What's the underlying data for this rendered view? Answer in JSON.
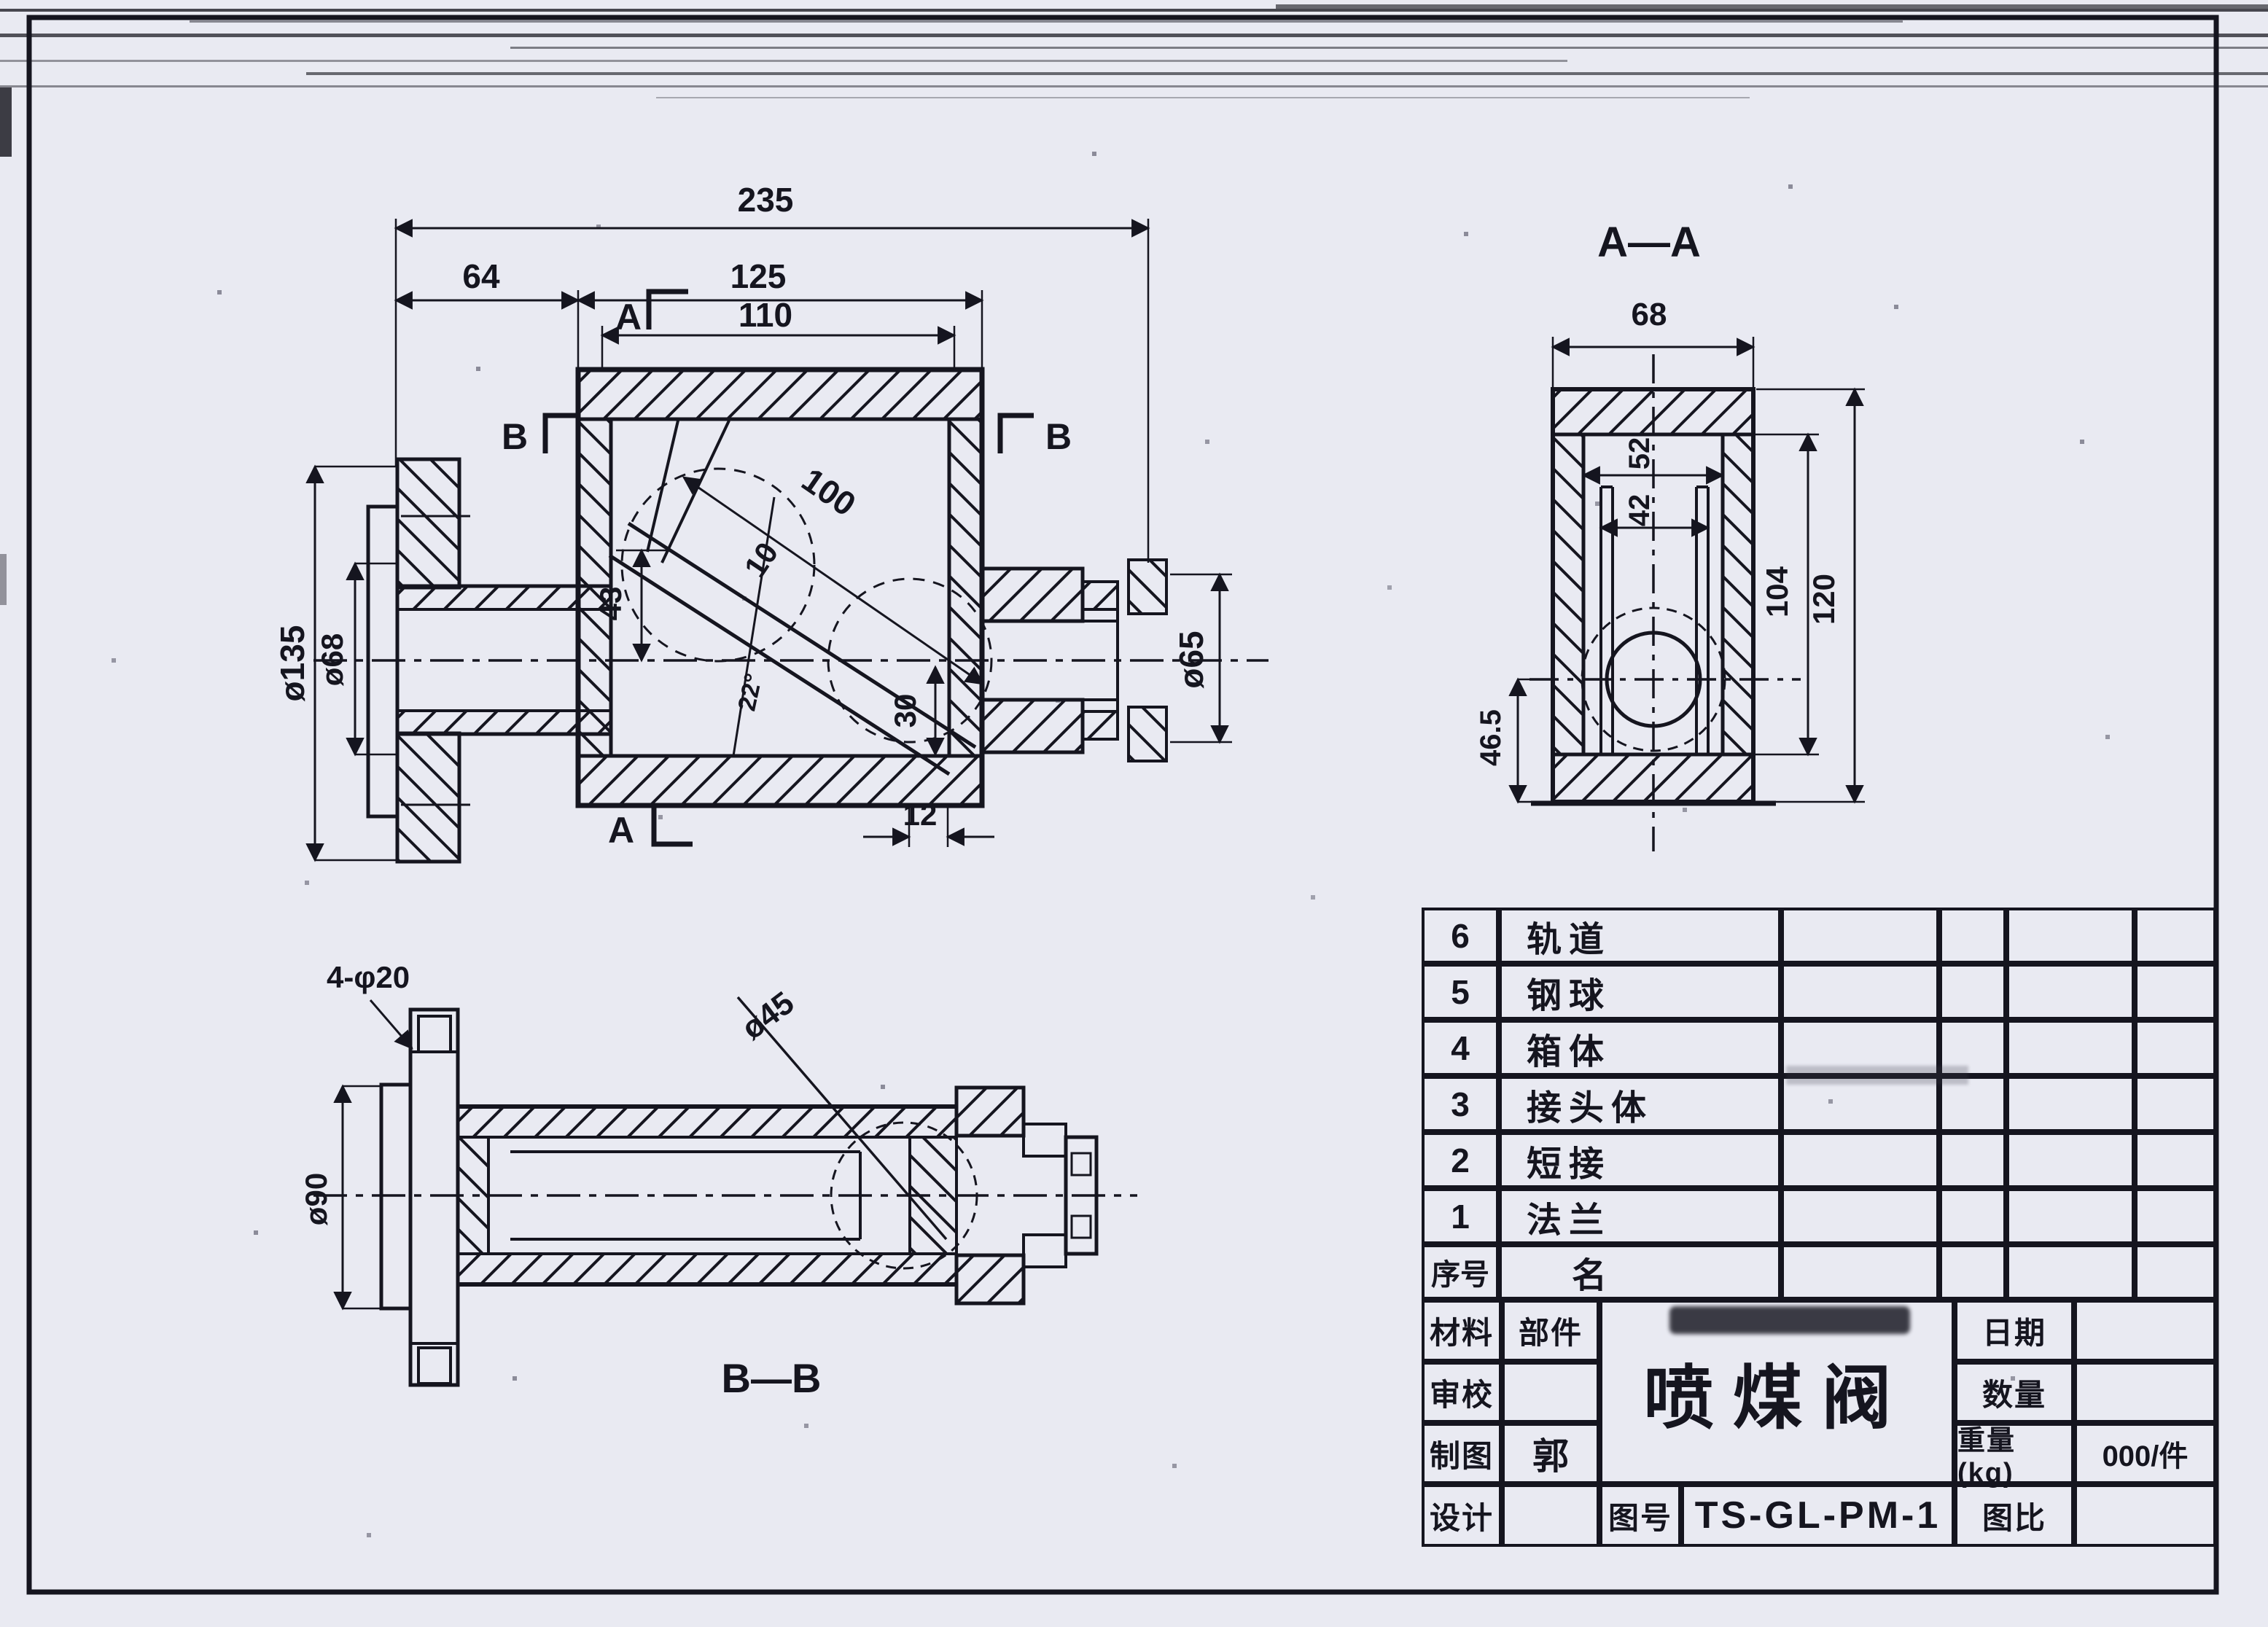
{
  "colors": {
    "ink": "#15151f",
    "paper": "#e9eaf2"
  },
  "main_view": {
    "markers": {
      "a": "A",
      "b": "B"
    },
    "dims": {
      "overall_length": "235",
      "flange_to_box": "64",
      "box_width": "125",
      "inner_width": "110",
      "flange_od": "ø135",
      "pipe_od": "ø68",
      "tube_offset": "43",
      "tube_length": "100",
      "tube_wall": "10",
      "outlet_bore": "30",
      "angle": "22°",
      "edge_offset": "12",
      "outlet_od": "ø65"
    }
  },
  "aa_view": {
    "label": "A—A",
    "dims": {
      "outer_width": "68",
      "rail_span": "52",
      "rail_inner": "42",
      "inner_height": "104",
      "outer_height": "120",
      "ball_to_base": "46.5"
    }
  },
  "bb_view": {
    "label": "B—B",
    "dims": {
      "bolt_holes": "4-φ20",
      "flange_od": "ø90",
      "bore": "ø45"
    }
  },
  "parts_table": {
    "rows": [
      {
        "no": "6",
        "name": "轨道"
      },
      {
        "no": "5",
        "name": "钢球"
      },
      {
        "no": "4",
        "name": "箱体"
      },
      {
        "no": "3",
        "name": "接头体"
      },
      {
        "no": "2",
        "name": "短接"
      },
      {
        "no": "1",
        "name": "法兰"
      },
      {
        "no": "序号",
        "name": "名"
      }
    ]
  },
  "title_block": {
    "material_label": "材料",
    "part_label": "部件",
    "review_label": "审校",
    "draft_label": "制图",
    "draft_value": "郭",
    "design_label": "设计",
    "title": "喷煤阀",
    "drawing_no_label": "图号",
    "drawing_no": "TS-GL-PM-1",
    "date_label": "日期",
    "qty_label": "数量",
    "weight_label": "重量(kg)",
    "weight_value": "000/件",
    "scale_label": "图比"
  }
}
